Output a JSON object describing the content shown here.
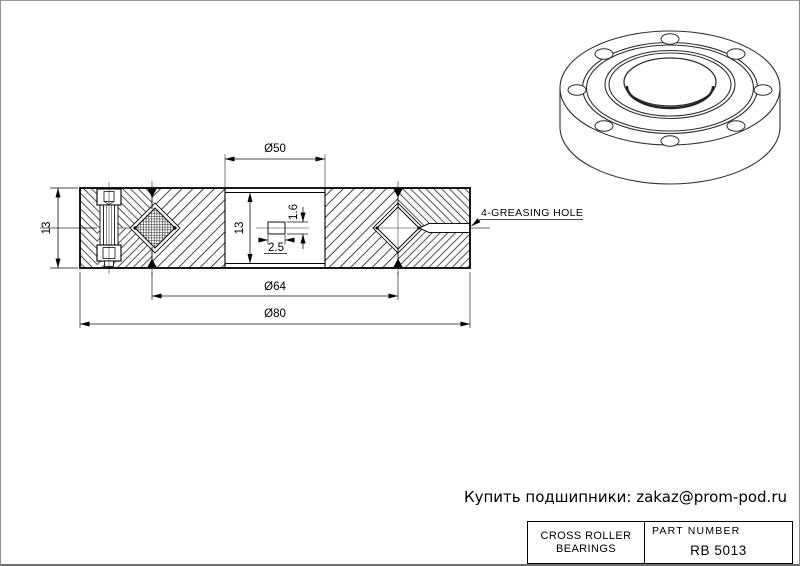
{
  "section_view": {
    "dim_bore": "Ø50",
    "dim_pitch": "Ø64",
    "dim_outer": "Ø80",
    "dim_width": "13",
    "dim_inner_width": "13",
    "dim_key_width": "2.5",
    "dim_key_height": "1.6",
    "greasing_label": "4-GREASING HOLE"
  },
  "footer": {
    "promo": "Купить подшипники: zakaz@prom-pod.ru"
  },
  "title_block": {
    "product_line1": "CROSS ROLLER",
    "product_line2": "BEARINGS",
    "part_label": "PART  NUMBER",
    "part_number": "RB 5013"
  },
  "colors": {
    "ink": "#000000",
    "frame": "#8c8c8c",
    "background": "#ffffff"
  }
}
